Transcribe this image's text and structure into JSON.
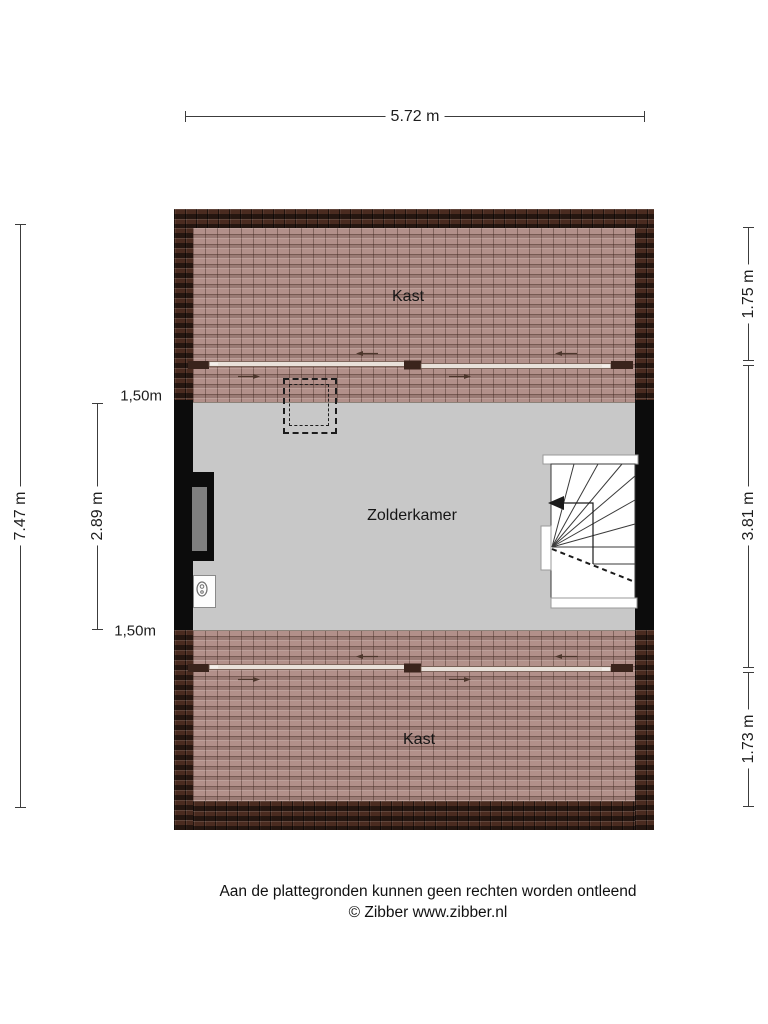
{
  "dimensions": {
    "width_total": "5.72 m",
    "height_total": "7.47 m",
    "room_height": "2.89 m",
    "knee_top": "1,50m",
    "knee_bottom": "1,50m",
    "right_top": "1.75 m",
    "right_middle": "3.81 m",
    "right_bottom": "1.73 m"
  },
  "rooms": {
    "closet_top": "Kast",
    "attic_room": "Zolderkamer",
    "closet_bottom": "Kast"
  },
  "footer": {
    "disclaimer": "Aan de plattegronden kunnen geen rechten worden ontleend",
    "credit": "© Zibber www.zibber.nl"
  },
  "colors": {
    "background": "#ffffff",
    "roof_tile_light": "#b2908a",
    "roof_tile_dark": "#4a2b20",
    "floor_gray": "#c8c8c8",
    "wall_black": "#0c0c0c",
    "dimension_line": "#3c3c3c",
    "window_glass": "#7f7f7f"
  }
}
